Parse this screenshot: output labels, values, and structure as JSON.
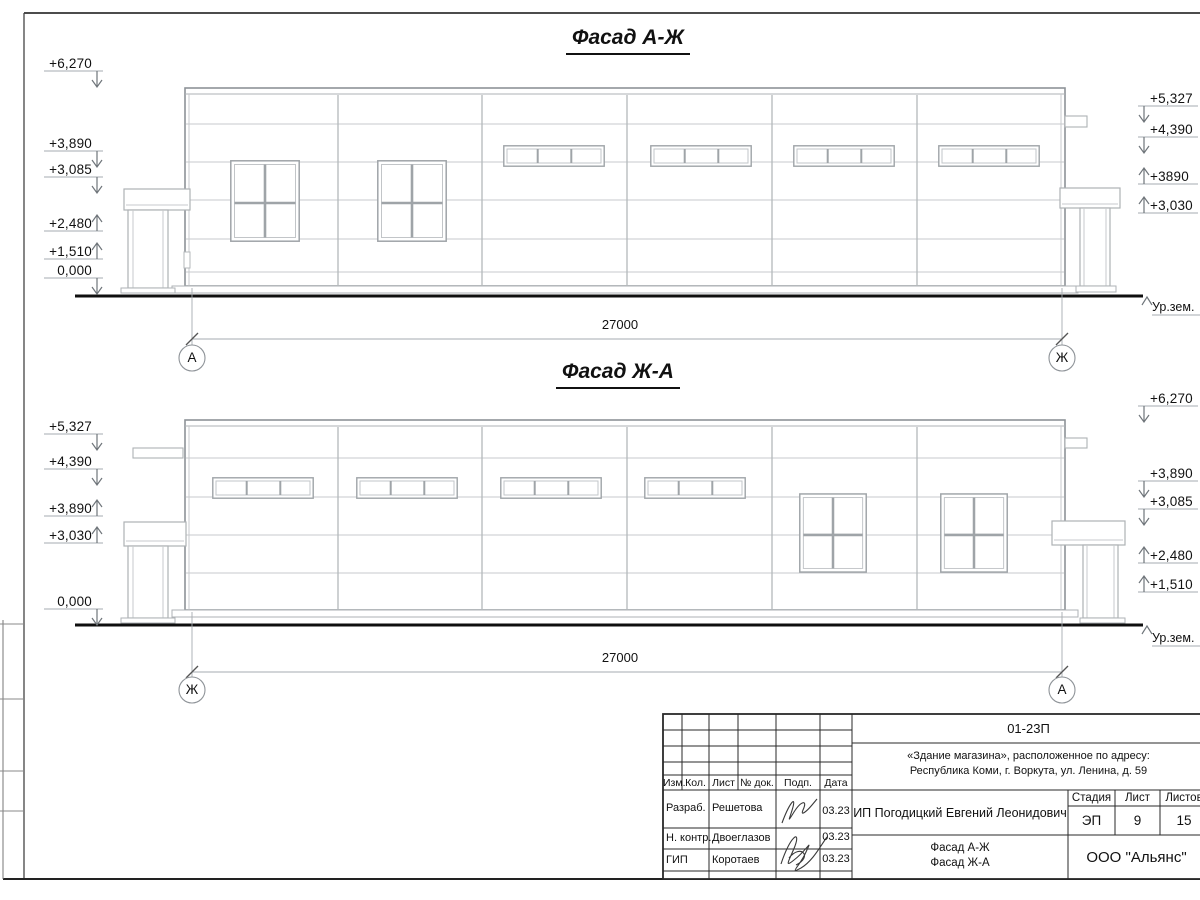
{
  "facades": [
    {
      "title": "Фасад А-Ж",
      "dim": "27000",
      "axis_left": "А",
      "axis_right": "Ж",
      "ground": "Ур.зем.",
      "marks_left": [
        "+6,270",
        "+3,890",
        "+3,085",
        "+2,480",
        "+1,510",
        "0,000"
      ],
      "marks_right": [
        "+5,327",
        "+4,390",
        "+3890",
        "+3,030"
      ]
    },
    {
      "title": "Фасад Ж-А",
      "dim": "27000",
      "axis_left": "Ж",
      "axis_right": "А",
      "ground": "Ур.зем.",
      "marks_left": [
        "+5,327",
        "+4,390",
        "+3,890",
        "+3,030",
        "0,000"
      ],
      "marks_right": [
        "+6,270",
        "+3,890",
        "+3,085",
        "+2,480",
        "+1,510"
      ]
    }
  ],
  "title_block": {
    "code": "01-23П",
    "project_line1": "«Здание магазина», расположенное по адресу:",
    "project_line2": "Республика Коми, г. Воркута, ул. Ленина, д. 59",
    "columns": [
      "Изм.",
      "Кол.",
      "Лист",
      "№ док.",
      "Подп.",
      "Дата"
    ],
    "rows": [
      {
        "role": "Разраб.",
        "name": "Решетова",
        "date": "03.23"
      },
      {
        "role": "Н. контр.",
        "name": "Двоеглазов",
        "date": "03.23"
      },
      {
        "role": "ГИП",
        "name": "Коротаев",
        "date": "03.23"
      }
    ],
    "client": "ИП Погодицкий Евгений Леонидович",
    "stage_label": "Стадия",
    "sheet_label": "Лист",
    "sheets_label": "Листов",
    "stage": "ЭП",
    "sheet_no": "9",
    "sheets_total": "15",
    "drawing_title_line1": "Фасад А-Ж",
    "drawing_title_line2": "Фасад Ж-А",
    "company": "ООО \"Альянс\""
  }
}
